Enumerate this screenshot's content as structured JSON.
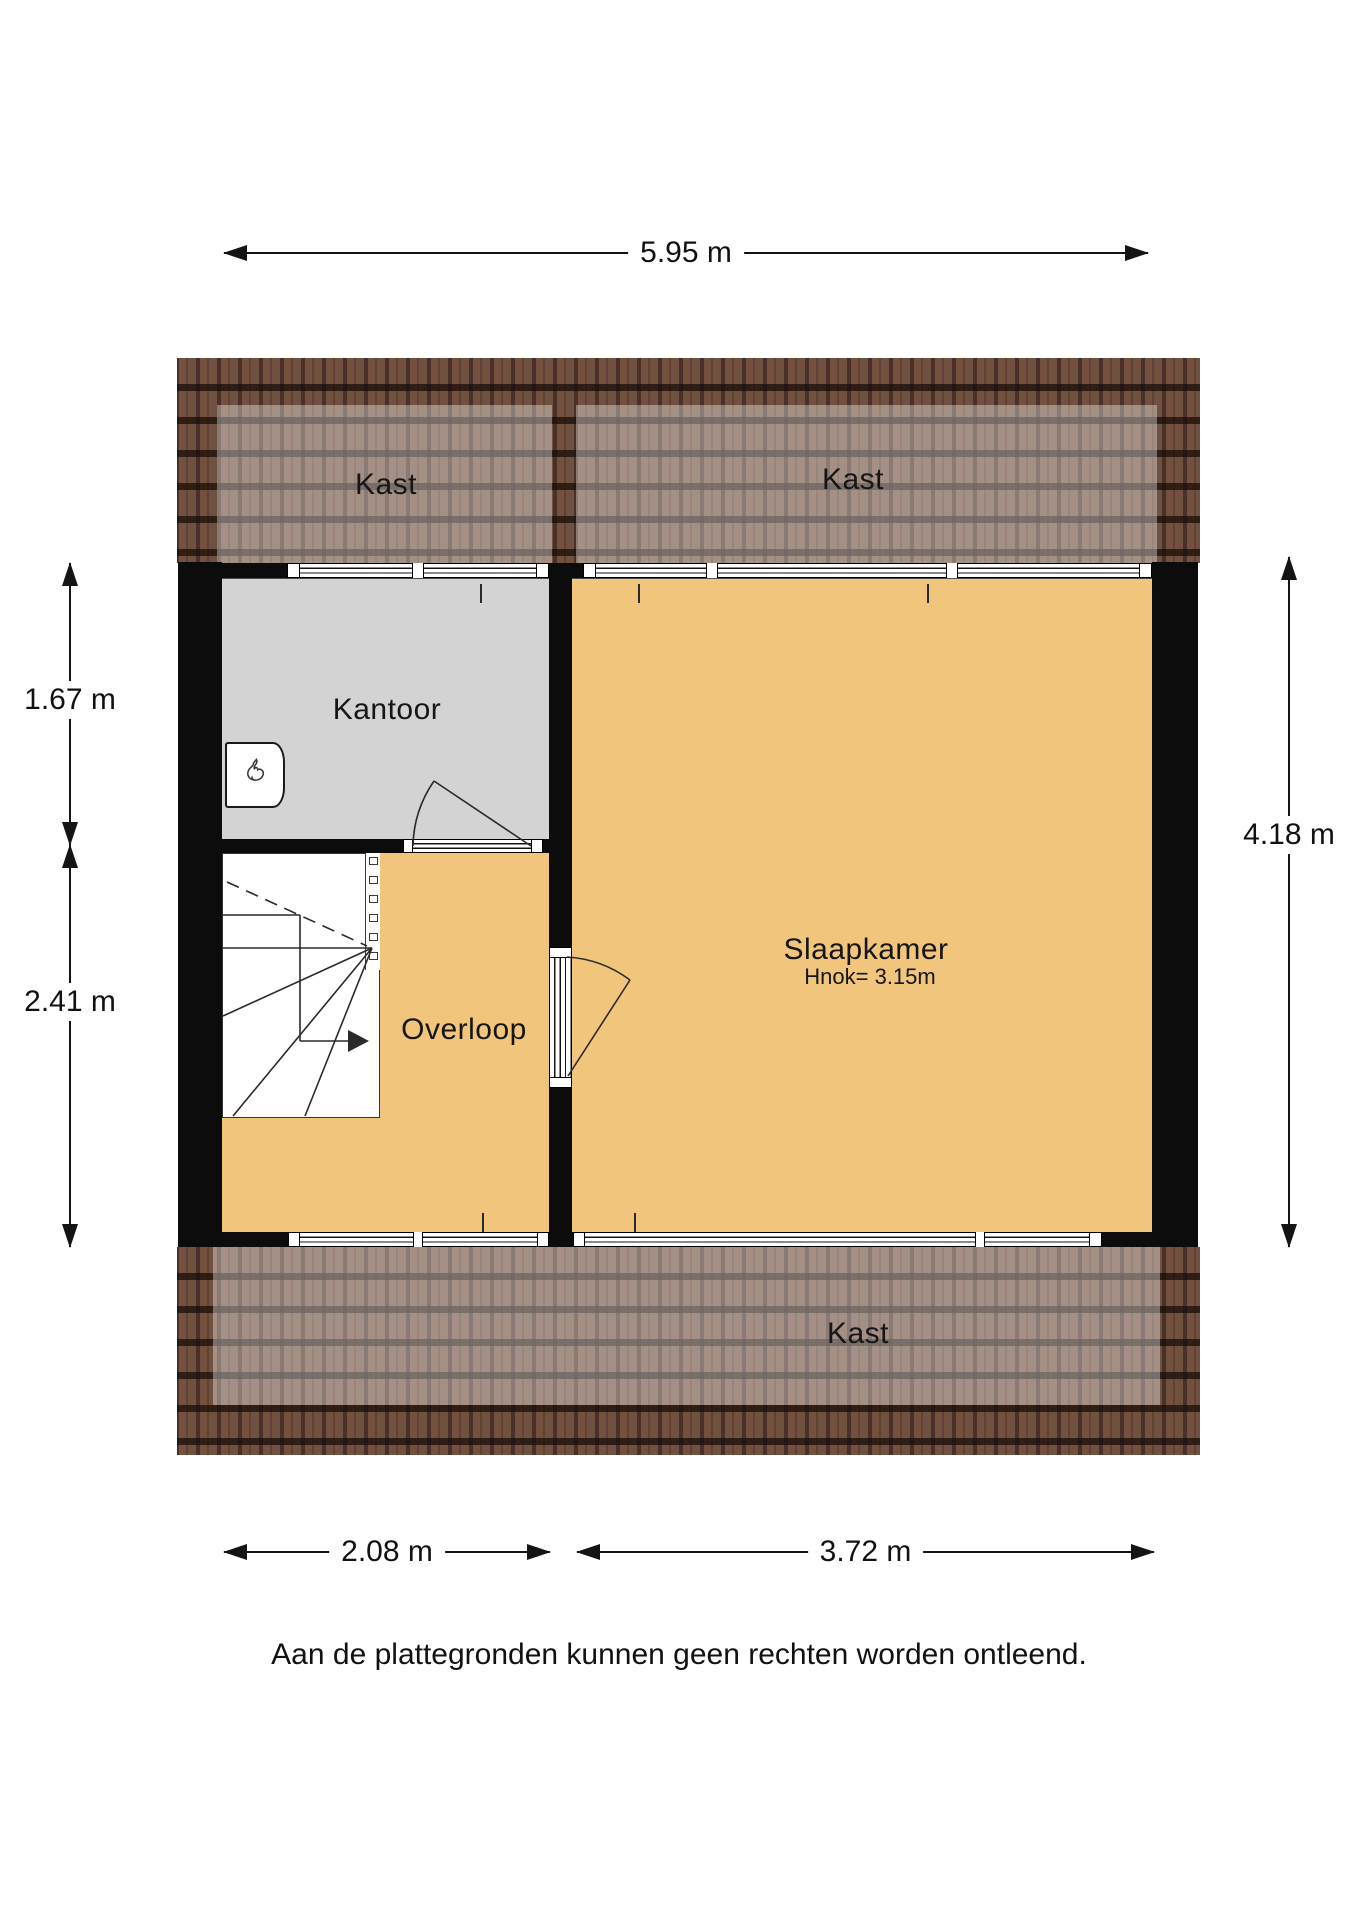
{
  "rooms": {
    "kast_top_left": {
      "label": "Kast"
    },
    "kast_top_right": {
      "label": "Kast"
    },
    "kast_bottom": {
      "label": "Kast"
    },
    "kantoor": {
      "label": "Kantoor"
    },
    "slaapkamer": {
      "label": "Slaapkamer",
      "height_note": "Hnok= 3.15m"
    },
    "overloop": {
      "label": "Overloop"
    }
  },
  "dimensions": {
    "overall_width": {
      "label": "5.95 m"
    },
    "kantoor_depth": {
      "label": "1.67 m"
    },
    "overloop_depth": {
      "label": "2.41 m"
    },
    "interior_height": {
      "label": "4.18 m"
    },
    "overloop_width": {
      "label": "2.08 m"
    },
    "slaapkamer_width": {
      "label": "3.72 m"
    }
  },
  "footer": {
    "disclaimer": "Aan de plattegronden kunnen geen rechten worden ontleend."
  },
  "colors": {
    "floor_orange": "#f2c57c",
    "floor_gray": "#d3d3d3",
    "wall_black": "#0c0c0c",
    "roof_base": "#5d4136"
  }
}
